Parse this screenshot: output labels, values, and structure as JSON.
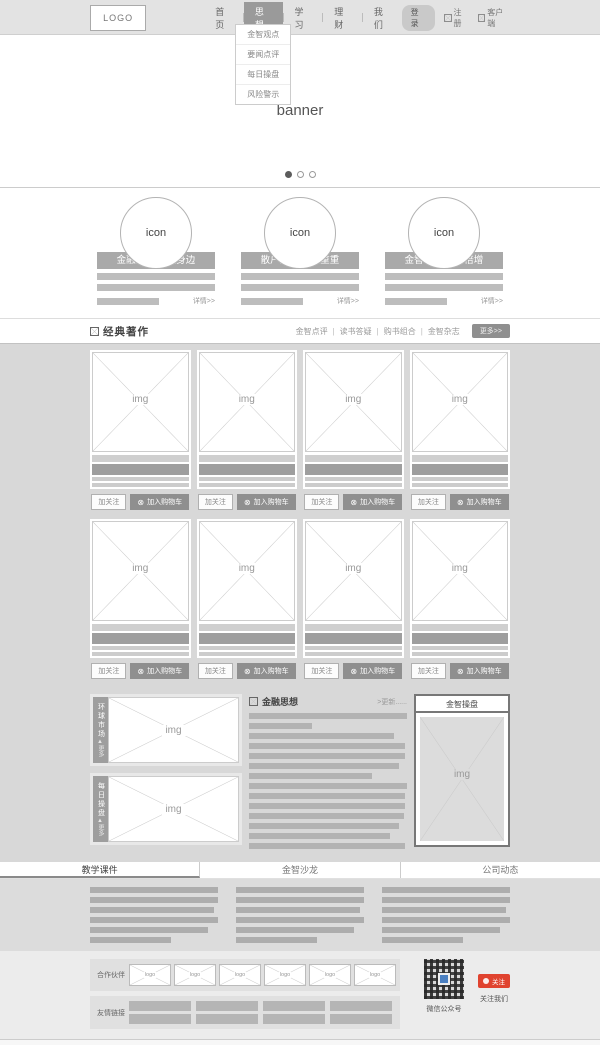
{
  "header": {
    "logo": "LOGO",
    "nav": [
      {
        "label": "首页"
      },
      {
        "label": "思想"
      },
      {
        "label": "学习"
      },
      {
        "label": "理财"
      },
      {
        "label": "我们"
      }
    ],
    "dropdown": [
      "金智观点",
      "要闻点评",
      "每日操盘",
      "风险警示"
    ],
    "login_label": "登录",
    "register_label": "注册",
    "client_label": "客户端"
  },
  "banner": {
    "label": "banner"
  },
  "features": [
    {
      "icon_label": "icon",
      "title": "金融浪潮 就在身边",
      "more": "详情>>"
    },
    {
      "icon_label": "icon",
      "title": "散户投资 困惑重重",
      "more": "详情>>"
    },
    {
      "icon_label": "icon",
      "title": "金智 助您财富倍增",
      "more": "详情>>"
    }
  ],
  "classics": {
    "title": "经典著作",
    "tabs": [
      "金智点评",
      "读书答疑",
      "购书组合",
      "金智杂志"
    ],
    "tab_separator": "|",
    "more_label": "更多>>",
    "card": {
      "img_label": "img",
      "follow_label": "加关注",
      "cart_label": "加入购物车",
      "cart_icon": "⊗"
    }
  },
  "middle": {
    "left_panels": [
      {
        "tab": "环球市场",
        "more": "▲更多",
        "img_label": "img"
      },
      {
        "tab": "每日操盘",
        "more": "▲更多",
        "img_label": "img"
      }
    ],
    "news": {
      "title": "金融思想",
      "more": ">更新......"
    },
    "trade": {
      "title": "金智操盘",
      "img_label": "img"
    }
  },
  "lower_tabs": [
    {
      "label": "教学课件"
    },
    {
      "label": "金智沙龙"
    },
    {
      "label": "公司动态"
    }
  ],
  "footer": {
    "partners_label": "合作伙伴",
    "partner_logo_label": "logo",
    "links_label": "友情链接",
    "qr_caption": "微信公众号",
    "follow_badge": "关注",
    "follow_caption": "关注我们"
  },
  "colors": {
    "accent_gray": "#9a9a9a",
    "badge_red": "#e0432f",
    "qr_blue": "#4a7fc1"
  }
}
